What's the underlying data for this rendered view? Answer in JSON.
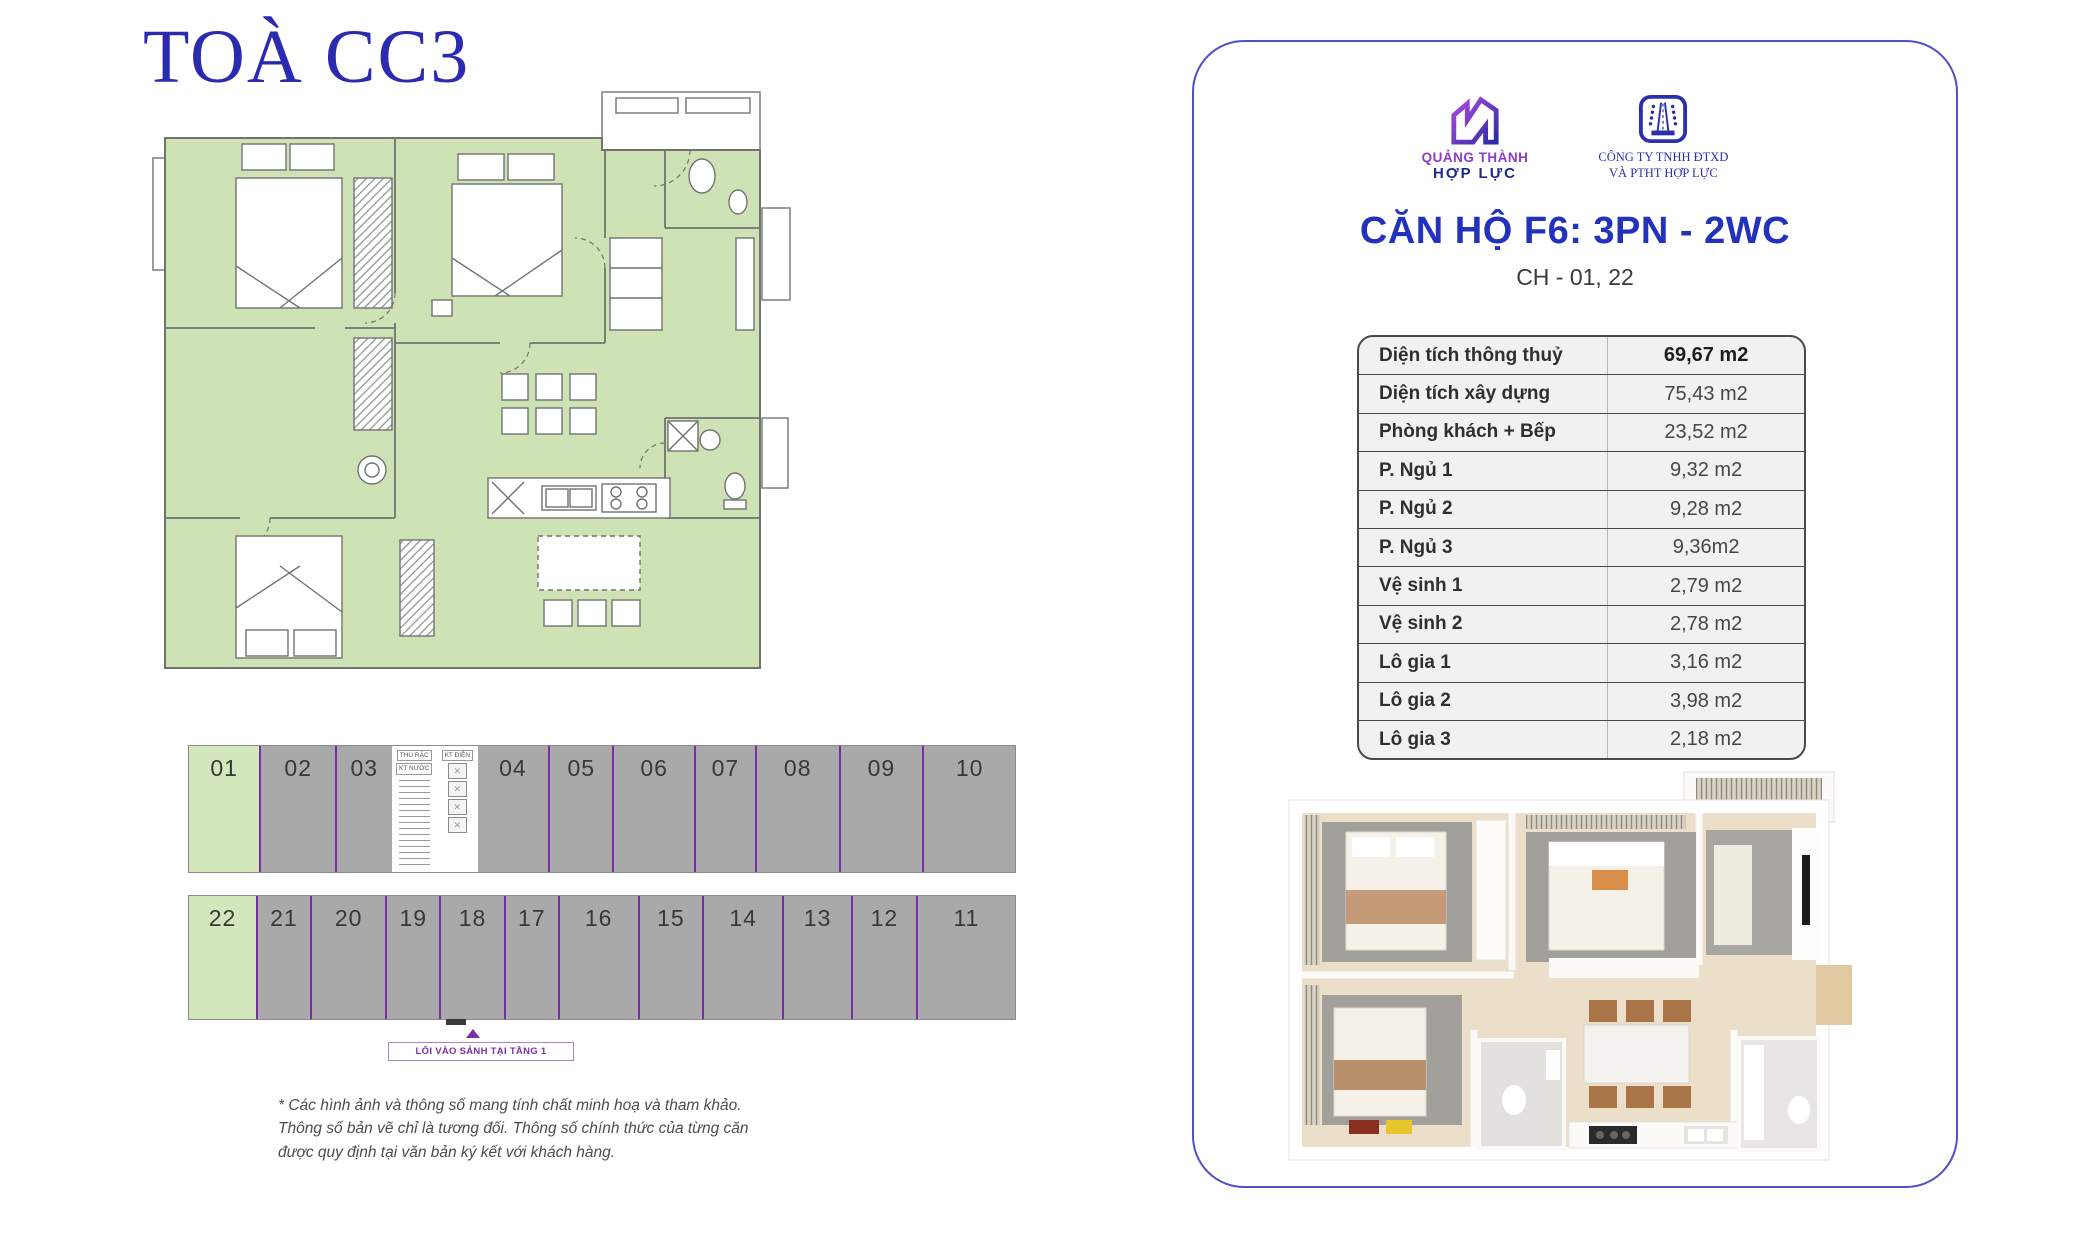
{
  "page": {
    "title": "TOÀ CC3"
  },
  "left": {
    "key_plan": {
      "top_row": [
        {
          "type": "unit",
          "label": "01",
          "hl": true
        },
        {
          "type": "unit",
          "label": "02"
        },
        {
          "type": "unit",
          "label": "03"
        },
        {
          "type": "core",
          "labels": [
            "THU RÁC",
            "KT NƯỚC"
          ]
        },
        {
          "type": "lifts",
          "label": "KT ĐIỆN"
        },
        {
          "type": "unit",
          "label": "04"
        },
        {
          "type": "unit",
          "label": "05"
        },
        {
          "type": "unit",
          "label": "06"
        },
        {
          "type": "unit",
          "label": "07"
        },
        {
          "type": "unit",
          "label": "08"
        },
        {
          "type": "unit",
          "label": "09"
        },
        {
          "type": "unit",
          "label": "10"
        }
      ],
      "bottom_row": [
        {
          "type": "unit",
          "label": "22",
          "hl": true
        },
        {
          "type": "unit",
          "label": "21"
        },
        {
          "type": "unit",
          "label": "20"
        },
        {
          "type": "unit",
          "label": "19"
        },
        {
          "type": "unit",
          "label": "18"
        },
        {
          "type": "unit",
          "label": "17"
        },
        {
          "type": "unit",
          "label": "16"
        },
        {
          "type": "unit",
          "label": "15"
        },
        {
          "type": "unit",
          "label": "14"
        },
        {
          "type": "unit",
          "label": "13"
        },
        {
          "type": "unit",
          "label": "12"
        },
        {
          "type": "unit",
          "label": "11"
        }
      ],
      "highlighted_units": [
        "01",
        "22"
      ],
      "entrance_label": "LỐI VÀO SẢNH TẠI TẦNG 1"
    },
    "disclaimer": "* Các hình ảnh và thông số mang tính chất minh hoạ và tham khảo. Thông số bản vẽ chỉ là tương đối. Thông số chính thức của từng căn được quy định tại văn bản ký kết với khách hàng."
  },
  "card": {
    "logos": [
      {
        "line1": "QUẢNG THÀNH",
        "line2": "HỢP LỰC"
      },
      {
        "line1": "CÔNG TY TNHH ĐTXD",
        "line2": "VÀ PTHT HỢP LỰC"
      }
    ],
    "apartment_title": "CĂN HỘ F6: 3PN - 2WC",
    "apartment_subtitle": "CH - 01, 22",
    "spec_table": {
      "rows": [
        {
          "label": "Diện tích thông thuỷ",
          "value": "69,67 m2",
          "bold": true
        },
        {
          "label": "Diện tích xây dựng",
          "value": "75,43 m2"
        },
        {
          "label": "Phòng khách + Bếp",
          "value": "23,52 m2"
        },
        {
          "label": "P. Ngủ 1",
          "value": "9,32 m2"
        },
        {
          "label": "P. Ngủ 2",
          "value": "9,28 m2"
        },
        {
          "label": "P. Ngủ 3",
          "value": "9,36m2"
        },
        {
          "label": "Vệ sinh 1",
          "value": "2,79 m2"
        },
        {
          "label": "Vệ sinh 2",
          "value": "2,78 m2"
        },
        {
          "label": "Lô gia 1",
          "value": "3,16 m2"
        },
        {
          "label": "Lô gia 2",
          "value": "3,98 m2"
        },
        {
          "label": "Lô gia 3",
          "value": "2,18 m2"
        }
      ]
    }
  },
  "colors": {
    "accent_blue": "#2232bc",
    "title_blue": "#2b2bb2",
    "card_border": "#4f4fc8",
    "plan_green": "#cfe2b6",
    "unit_gray": "#a9a9a9",
    "unit_purple": "#7a2fa6",
    "logo_purple": "#8c3cc9",
    "logo_navy": "#1f2a86"
  }
}
